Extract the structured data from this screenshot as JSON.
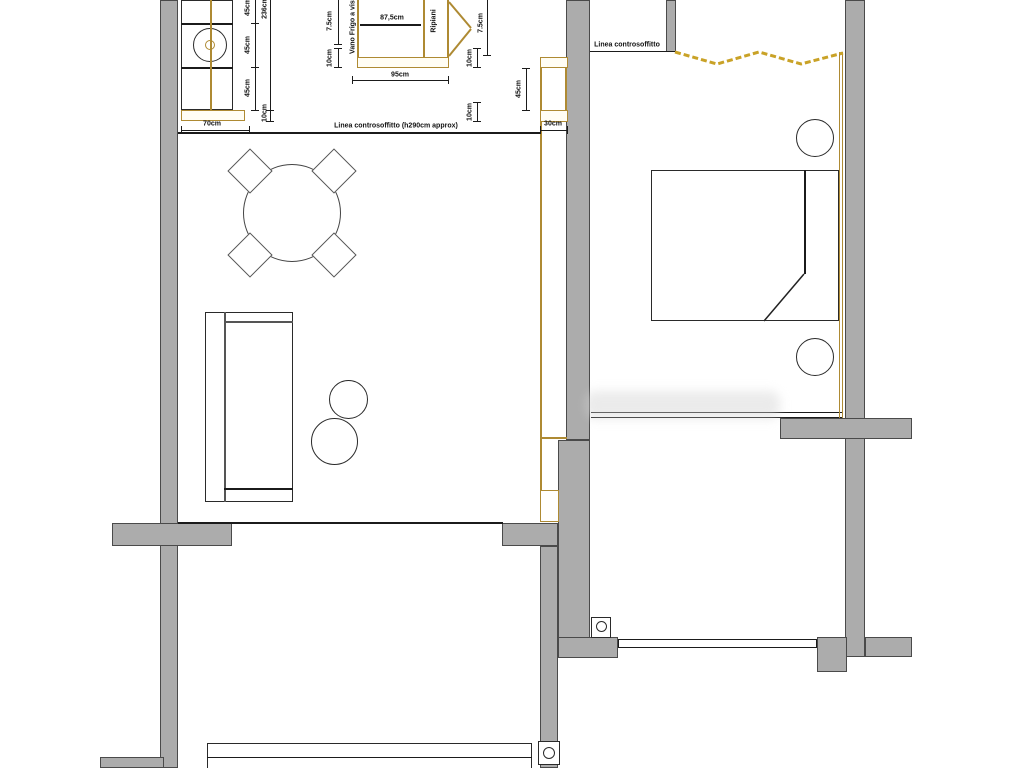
{
  "plan": {
    "annotations": {
      "ceiling_line_full": "Linea controsoffitto (h290cm approx)",
      "ceiling_line_short": "Linea controsoffitto",
      "fridge_bay": "Vano Frigo a vista",
      "shelves": "Ripiani"
    },
    "dims": {
      "left_col": [
        "45cm",
        "45cm",
        "45cm"
      ],
      "left_total": "236cm",
      "left_counter_depth": "10cm",
      "mid_gap_a": "7.5cm",
      "mid_gap_b": "10cm",
      "cabinet_inner_width": "87,5cm",
      "cabinet_total_width": "95cm",
      "right_gap_a": "7.5cm",
      "right_gap_b": "10cm",
      "right_gap_c": "10cm",
      "right_unit_height": "45cm",
      "right_unit_depth": "30cm",
      "counter_width": "70cm"
    },
    "colors": {
      "wall": "#ACACAC",
      "wall_outline": "#4A4A4A",
      "drawing_line": "#1B1B1B",
      "wood_accent": "#AE8A33",
      "curtain_accent": "#C9A227"
    }
  }
}
